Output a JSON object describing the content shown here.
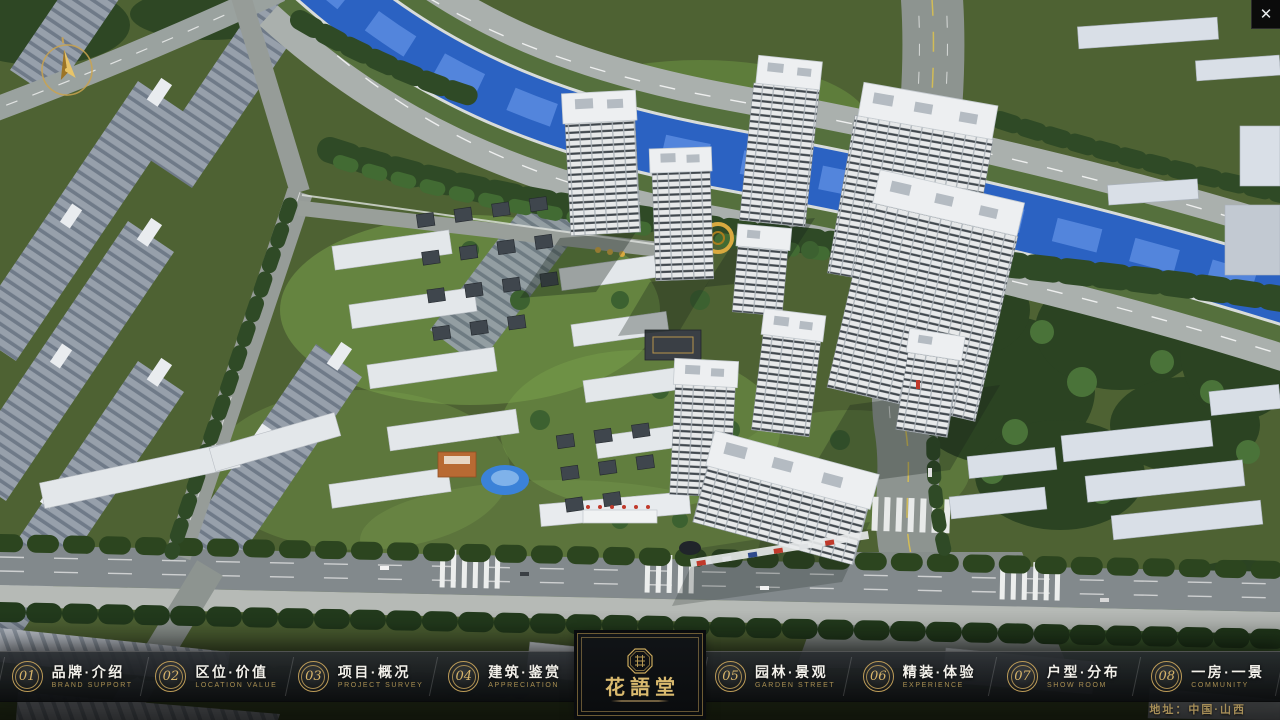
{
  "window": {
    "close_glyph": "✕"
  },
  "nav": {
    "items": [
      {
        "number": "01",
        "title": "品牌·介绍",
        "subtitle": "BRAND SUPPORT"
      },
      {
        "number": "02",
        "title": "区位·价值",
        "subtitle": "LOCATION VALUE"
      },
      {
        "number": "03",
        "title": "项目·概况",
        "subtitle": "PROJECT SURVEY"
      },
      {
        "number": "04",
        "title": "建筑·鉴赏",
        "subtitle": "APPRECIATION"
      },
      {
        "number": "05",
        "title": "园林·景观",
        "subtitle": "GARDEN STREET"
      },
      {
        "number": "06",
        "title": "精装·体验",
        "subtitle": "EXPERIENCE"
      },
      {
        "number": "07",
        "title": "户型·分布",
        "subtitle": "SHOW ROOM"
      },
      {
        "number": "08",
        "title": "一房·一景",
        "subtitle": "COMMUNITY"
      }
    ]
  },
  "logo": {
    "title": "花語堂"
  },
  "footer": {
    "address": "地址：中国·山西"
  },
  "colors": {
    "gold": "#bd9c58",
    "bar_bg": "#0d1013",
    "river": "#2b62c2",
    "ground": "#4e6233"
  }
}
